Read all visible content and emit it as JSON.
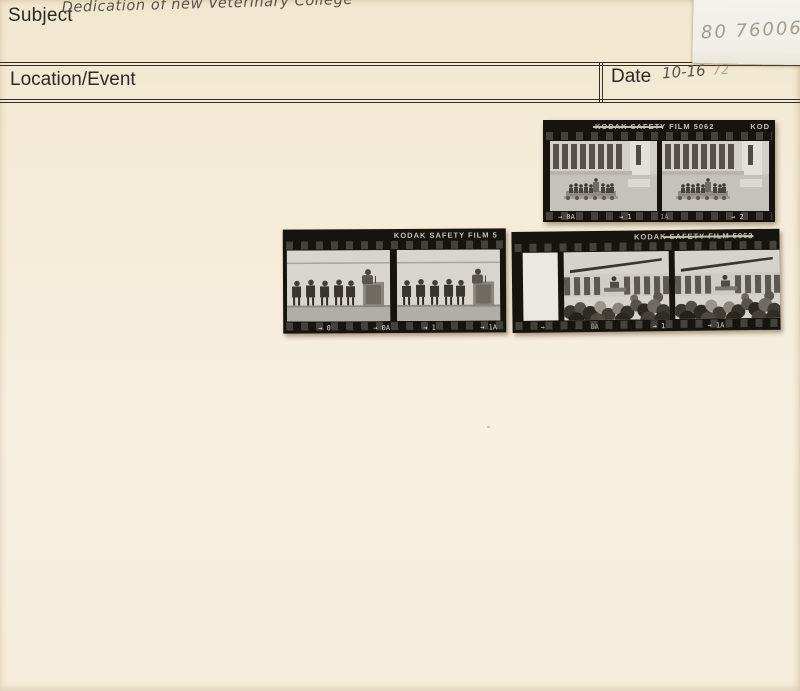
{
  "card": {
    "subject_label": "Subject",
    "subject_value": "Dedication of new Veterinary College",
    "location_label": "Location/Event",
    "location_value": "",
    "date_label": "Date",
    "date_value": "10-16",
    "date_value_partial": "72"
  },
  "sticky_note": {
    "number": "80 76006"
  },
  "film_strips": [
    {
      "name": "top-strip",
      "edge_label": "KODAK SAFETY FILM 5062",
      "edge_label_struck": true,
      "corner_label": "KOD",
      "markers": [
        "→ 0A",
        "→ 1",
        "1A",
        "→ 2"
      ],
      "frames": [
        "stage-platform-in-front-of-building",
        "stage-platform-in-front-of-building"
      ]
    },
    {
      "name": "middle-left-strip",
      "edge_label": "KODAK SAFETY FILM 5",
      "edge_label_struck": false,
      "corner_label": "",
      "markers": [
        "→ 0",
        "→ 0A",
        "→ 1",
        "→ 1A"
      ],
      "frames": [
        "speaker-at-podium-with-seated-guests",
        "speaker-at-podium-with-seated-guests"
      ]
    },
    {
      "name": "middle-right-strip",
      "edge_label": "KODAK SAFETY FILM 5062",
      "edge_label_struck": true,
      "corner_label": "",
      "markers": [
        "→",
        "0A",
        "→ 1",
        "→ 1A"
      ],
      "frames": [
        "blank",
        "audience-viewed-from-behind-facing-speaker",
        "audience-viewed-from-behind-facing-speaker"
      ]
    }
  ],
  "colors": {
    "card_background": "#f4ebd7",
    "rule_ink": "#332e25",
    "printed_label_ink": "#2e2a23",
    "pen_ink": "#575249",
    "pencil": "#a39c90",
    "note_paper": "#f2f0e9",
    "film_base": "#17130e",
    "film_edge_text": "#c8c2b1"
  }
}
